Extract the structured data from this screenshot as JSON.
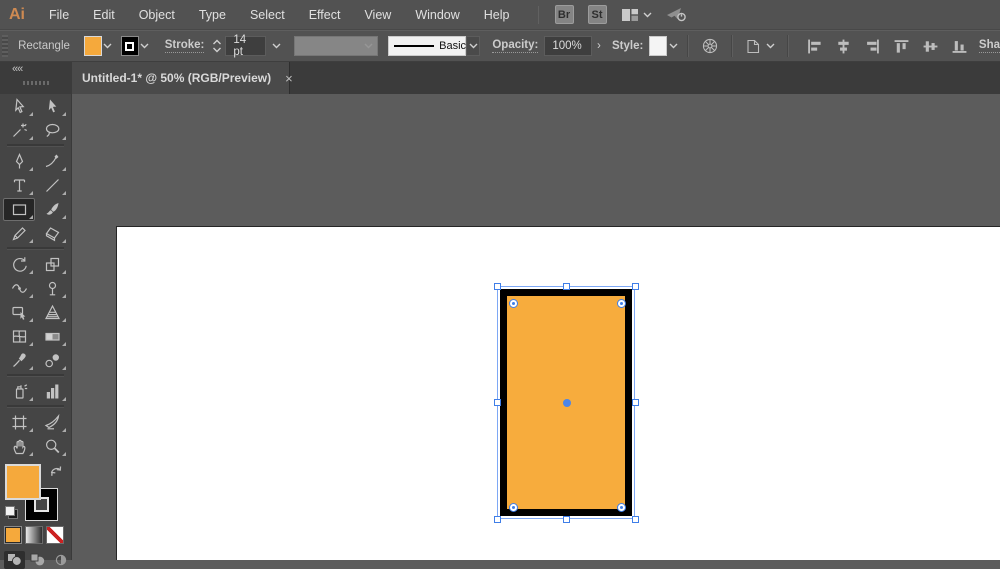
{
  "app": {
    "logo": "Ai"
  },
  "menubar": {
    "items": [
      "File",
      "Edit",
      "Object",
      "Type",
      "Select",
      "Effect",
      "View",
      "Window",
      "Help"
    ],
    "bridge_button": "Br",
    "stock_button": "St",
    "right_icons": [
      "workspace-switcher-icon",
      "share-icon"
    ]
  },
  "controlbar": {
    "context_label": "Rectangle",
    "stroke_label": "Stroke:",
    "stroke_weight": "14 pt",
    "stroke_style": "Basic",
    "opacity_label": "Opacity:",
    "opacity_value": "100%",
    "opacity_more": "›",
    "style_label": "Style:",
    "shape_label_truncated": "Sha",
    "align_tools": [
      "align-left",
      "align-h-center",
      "align-right",
      "align-top",
      "align-v-center",
      "align-bottom"
    ]
  },
  "tab": {
    "title": "Untitled-1* @ 50% (RGB/Preview)",
    "close": "×",
    "collapse_glyph": "««"
  },
  "toolbar": {
    "selected_tool": "rectangle",
    "rows": [
      [
        "selection",
        "direct-selection"
      ],
      [
        "magic-wand",
        "lasso"
      ],
      "divider",
      [
        "pen",
        "curvature"
      ],
      [
        "type",
        "line-segment"
      ],
      [
        "rectangle",
        "paintbrush"
      ],
      [
        "pencil",
        "eraser"
      ],
      "divider",
      [
        "rotate",
        "scale"
      ],
      [
        "width",
        "puppet-warp"
      ],
      [
        "shape-builder",
        "perspective-grid"
      ],
      [
        "mesh",
        "gradient"
      ],
      [
        "eyedropper",
        "blend"
      ],
      "divider",
      [
        "symbol-sprayer",
        "column-graph"
      ],
      "divider",
      [
        "artboard",
        "slice"
      ],
      [
        "hand",
        "zoom"
      ]
    ],
    "draw_modes": [
      "draw-normal",
      "draw-behind",
      "draw-inside"
    ]
  },
  "colors": {
    "object_fill": "#F7AC3D",
    "object_stroke": "#000000",
    "fill_swatch": "#F5A93C",
    "selection_blue": "#7EA8F5",
    "handle_border": "#3F7EE8"
  },
  "document": {
    "zoom_in_tab": "50%",
    "color_mode_in_tab": "RGB/Preview"
  }
}
